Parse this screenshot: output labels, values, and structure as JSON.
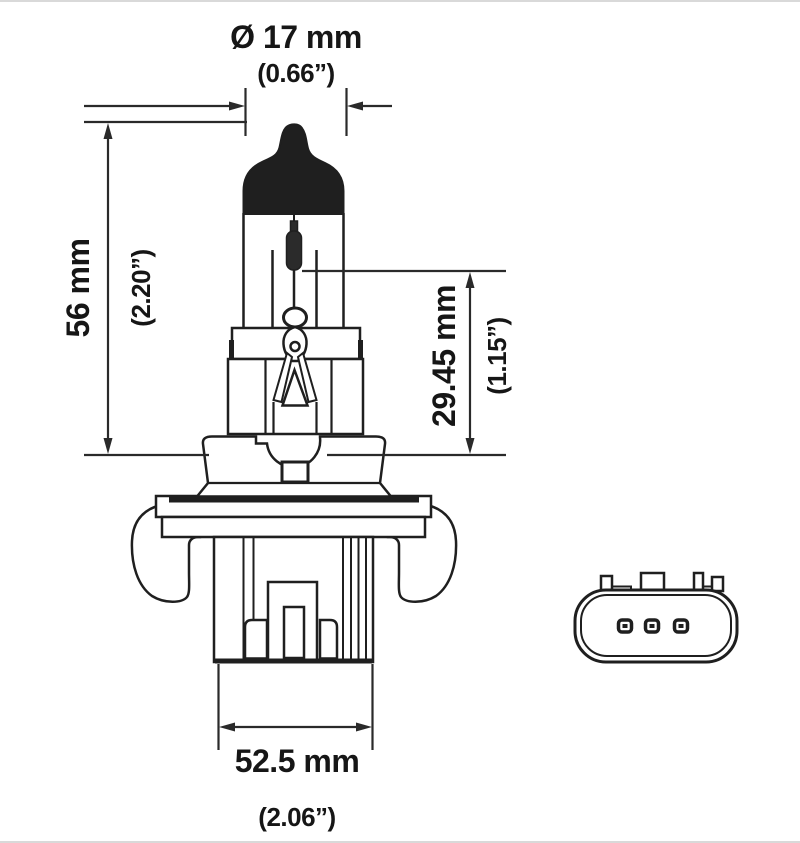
{
  "diagram": {
    "background_color": "#ffffff",
    "line_color": "#1f1f1f",
    "subject": "halogen headlight bulb technical drawing with connector front view",
    "labels": {
      "diameter_metric": "Ø 17 mm",
      "diameter_imperial": "(0.66”)",
      "length_metric": "56 mm",
      "length_imperial": "(2.20”)",
      "light_center_metric": "29.45 mm",
      "light_center_imperial": "(1.15”)",
      "base_width_metric": "52.5 mm",
      "base_width_imperial": "(2.06”)"
    }
  }
}
